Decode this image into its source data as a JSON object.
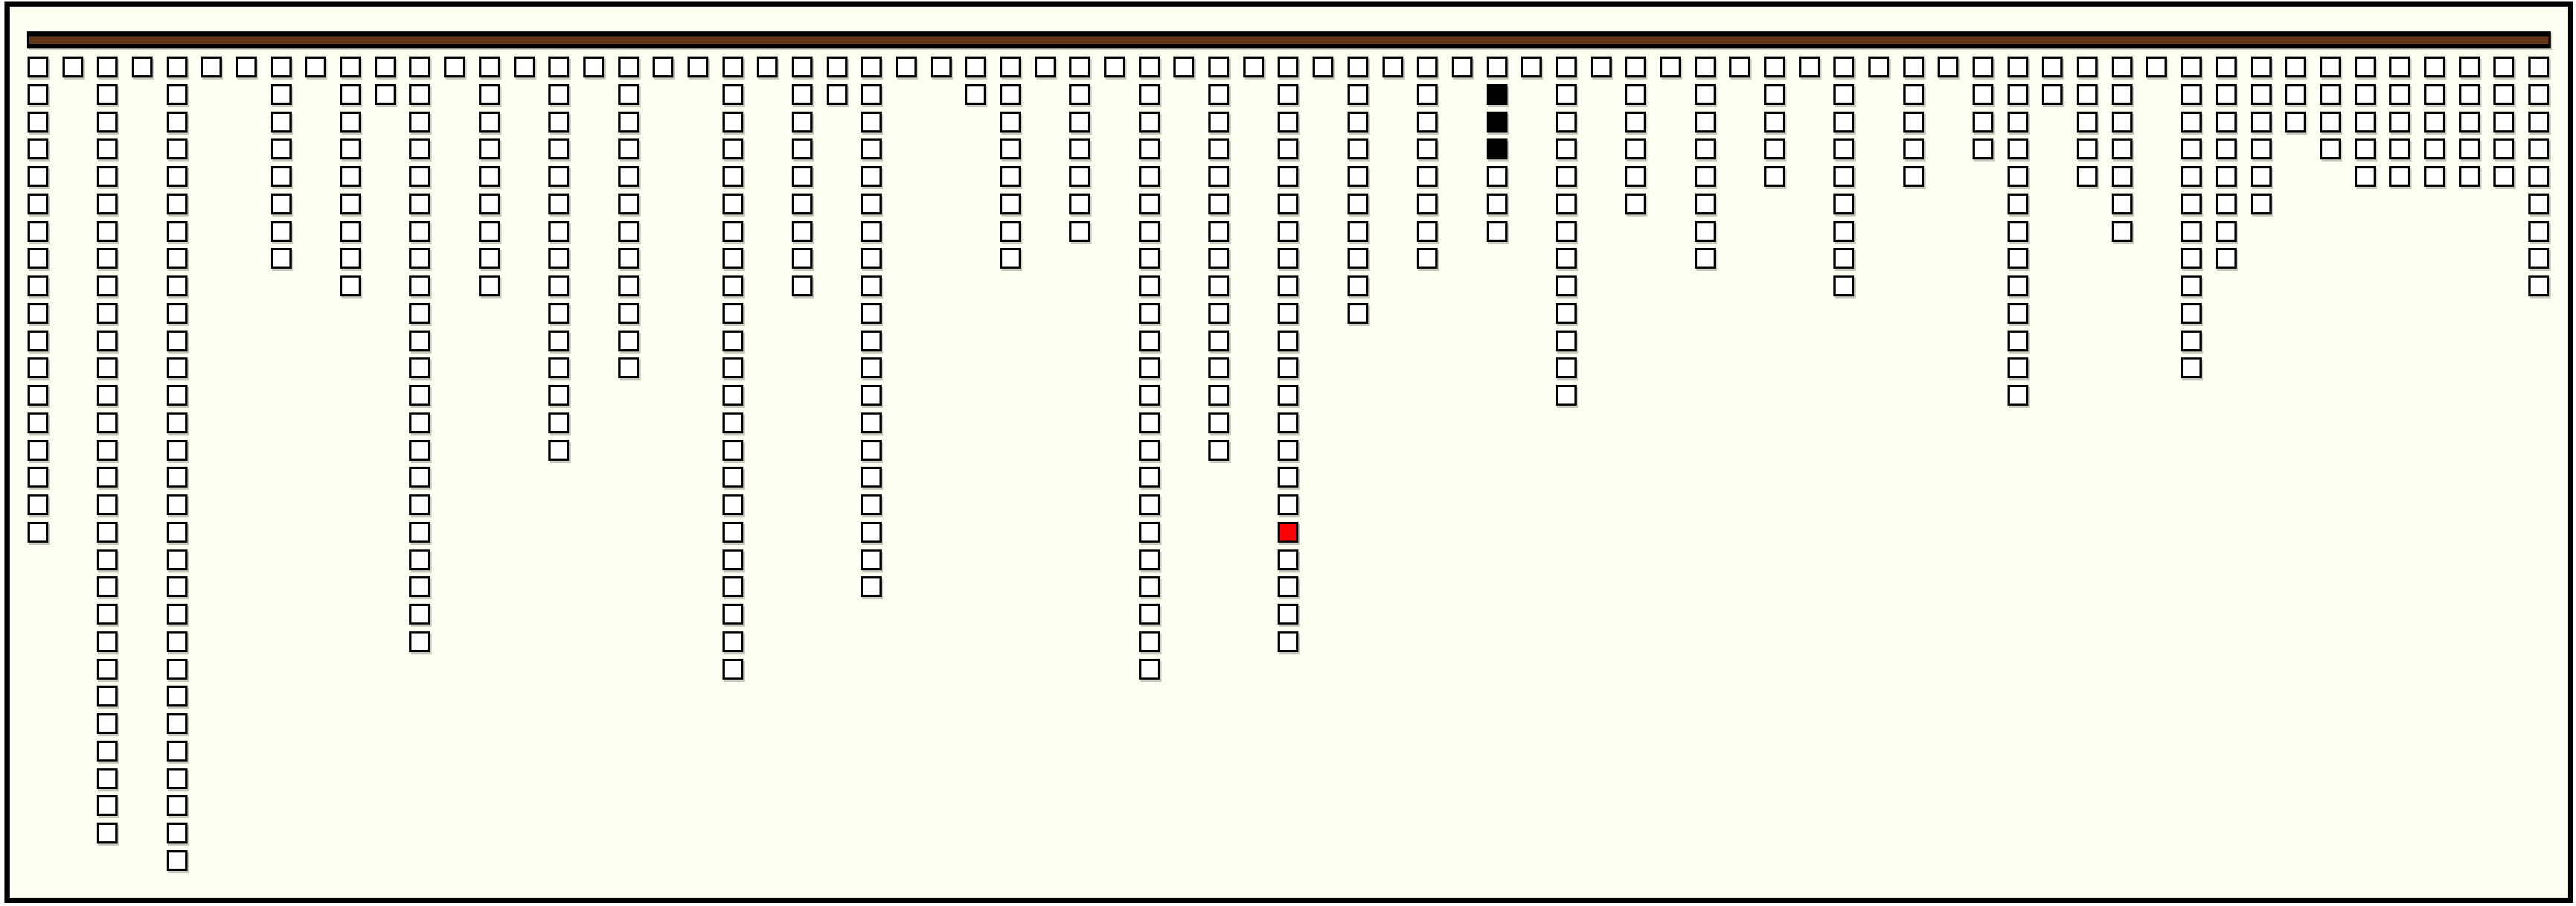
{
  "window": {
    "outer_background": "#ffffff",
    "inner_background": "#fffff2",
    "frame_color": "#000000"
  },
  "top_bar": {
    "edge_color": "#000000",
    "fill_color": "#64341b"
  },
  "cells": {
    "default_fill": "#ffffff",
    "border_color": "#000000",
    "black_fill": "#000000",
    "red_fill": "#ff0000"
  },
  "board": {
    "num_columns": 73,
    "max_rows": 30,
    "column_heights": [
      18,
      1,
      29,
      1,
      30,
      1,
      1,
      8,
      1,
      9,
      2,
      22,
      1,
      9,
      1,
      15,
      1,
      12,
      1,
      1,
      23,
      1,
      9,
      2,
      20,
      1,
      1,
      2,
      8,
      1,
      7,
      1,
      23,
      1,
      15,
      1,
      22,
      1,
      10,
      1,
      8,
      1,
      7,
      1,
      13,
      1,
      6,
      1,
      8,
      1,
      5,
      1,
      9,
      1,
      5,
      1,
      4,
      13,
      2,
      5,
      7,
      1,
      12,
      8,
      6,
      3,
      4,
      5,
      5,
      5,
      5,
      5,
      9
    ],
    "special_cells": [
      {
        "col": 36,
        "row": 17,
        "color": "red"
      },
      {
        "col": 42,
        "row": 1,
        "color": "black"
      },
      {
        "col": 42,
        "row": 2,
        "color": "black"
      },
      {
        "col": 42,
        "row": 3,
        "color": "black"
      }
    ]
  }
}
